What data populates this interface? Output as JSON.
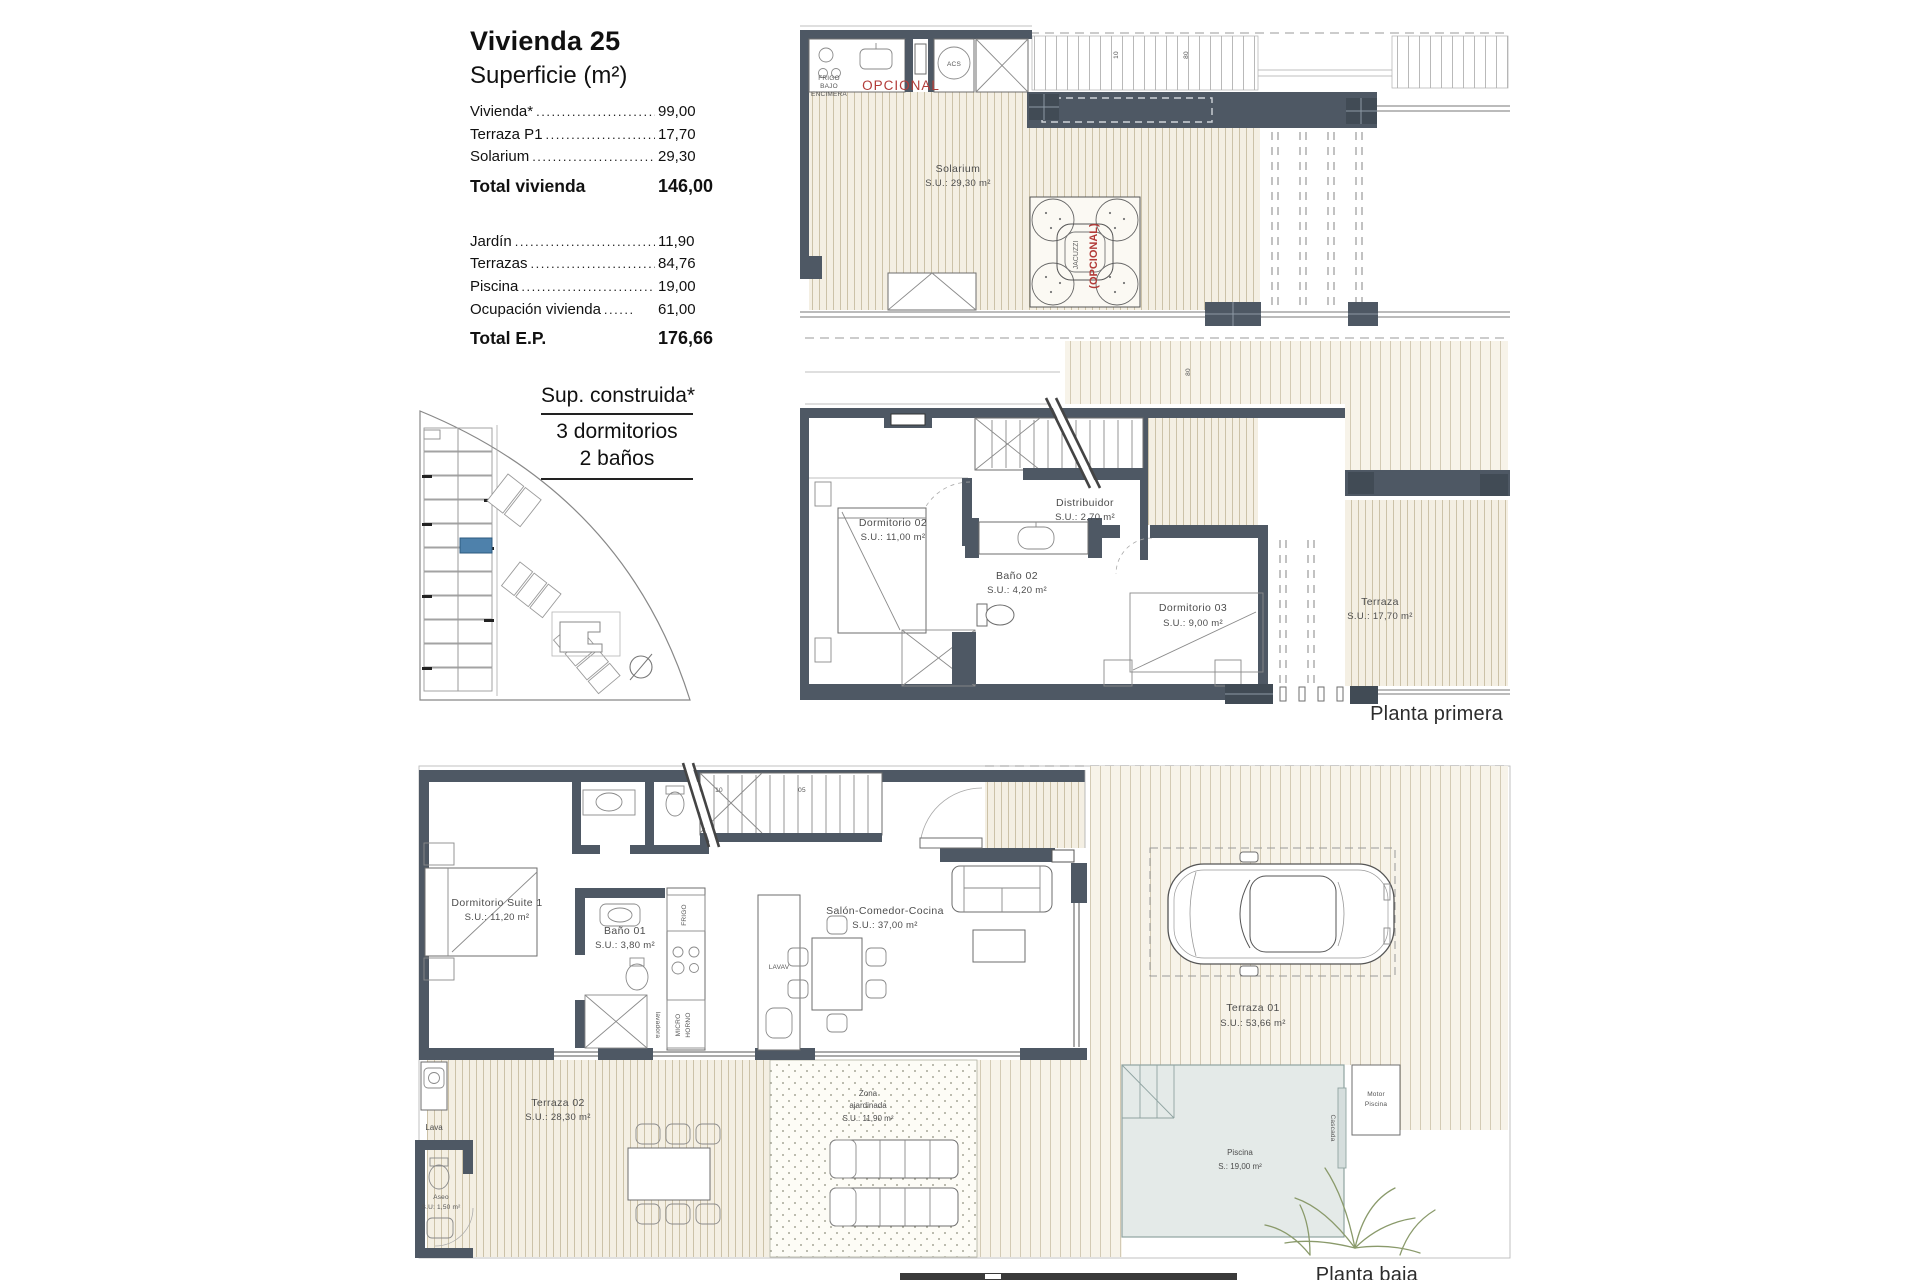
{
  "panel": {
    "title": "Vivienda 25",
    "subtitle": "Superficie (m²)",
    "rows_a": [
      {
        "label": "Vivienda*",
        "dots": "....................................",
        "value": "99,00"
      },
      {
        "label": "Terraza P1",
        "dots": "....................................",
        "value": "17,70"
      },
      {
        "label": "Solarium",
        "dots": "....................................",
        "value": "29,30"
      }
    ],
    "total_a": {
      "label": "Total vivienda",
      "value": "146,00"
    },
    "rows_b": [
      {
        "label": "Jardín",
        "dots": "....................................",
        "value": "11,90"
      },
      {
        "label": "Terrazas",
        "dots": "....................................",
        "value": "84,76"
      },
      {
        "label": "Piscina",
        "dots": "....................................",
        "value": "19,00"
      },
      {
        "label": "Ocupación vivienda",
        "dots": "......",
        "value": "61,00"
      }
    ],
    "total_b": {
      "label": "Total E.P.",
      "value": "176,66"
    },
    "construida": {
      "line1": "Sup. construida*",
      "line2": "3 dormitorios",
      "line3": "2 baños"
    }
  },
  "plans": {
    "solarium": {
      "label": "Planta solarium",
      "room_name": "Solarium",
      "room_area": "S.U.: 29,30 m²",
      "opcional": "OPCIONAL",
      "frigo1": "FRIGO",
      "frigo2": "BAJO",
      "frigo3": "ENCIMERA",
      "acs": "ACS",
      "jacuzzi1": "JACUZZI",
      "jacuzzi2": "(OPCIONAL)",
      "dim1": "10",
      "dim2": "80"
    },
    "primera": {
      "label": "Planta primera",
      "dorm02_name": "Dormitorio 02",
      "dorm02_area": "S.U.: 11,00 m²",
      "bano02_name": "Baño 02",
      "bano02_area": "S.U.: 4,20 m²",
      "distrib_name": "Distribuidor",
      "distrib_area": "S.U.: 2,70 m²",
      "dorm03_name": "Dormitorio 03",
      "dorm03_area": "S.U.: 9,00 m²",
      "terraza_name": "Terraza",
      "terraza_area": "S.U.: 17,70 m²",
      "dim1": "80"
    },
    "baja": {
      "label": "Planta baja",
      "suite_name": "Dormitorio Suite 1",
      "suite_area": "S.U.: 11,20 m²",
      "bano01_name": "Baño 01",
      "bano01_area": "S.U.: 3,80 m²",
      "salon_name": "Salón-Comedor-Cocina",
      "salon_area": "S.U.: 37,00 m²",
      "terraza02_name": "Terraza 02",
      "terraza02_area": "S.U.: 28,30 m²",
      "zona1": "Zona",
      "zona2": "ajardinada",
      "zona3": "S.U.: 11,90 m²",
      "terraza01_name": "Terraza 01",
      "terraza01_area": "S.U.: 53,66 m²",
      "piscina_name": "Piscina",
      "piscina_area": "S.: 19,00 m²",
      "aseo_name": "Aseo",
      "aseo_area": "S.U: 1,50 m²",
      "lava": "Lava",
      "motor1": "Motor",
      "motor2": "Piscina",
      "cascada": "Cascada",
      "lavav": "LAVAV",
      "frigo": "FRIGO",
      "micro1": "MICRO",
      "micro2": "HORNO",
      "lavadora": "lavadora",
      "stair1": "10",
      "stair2": "05"
    }
  }
}
